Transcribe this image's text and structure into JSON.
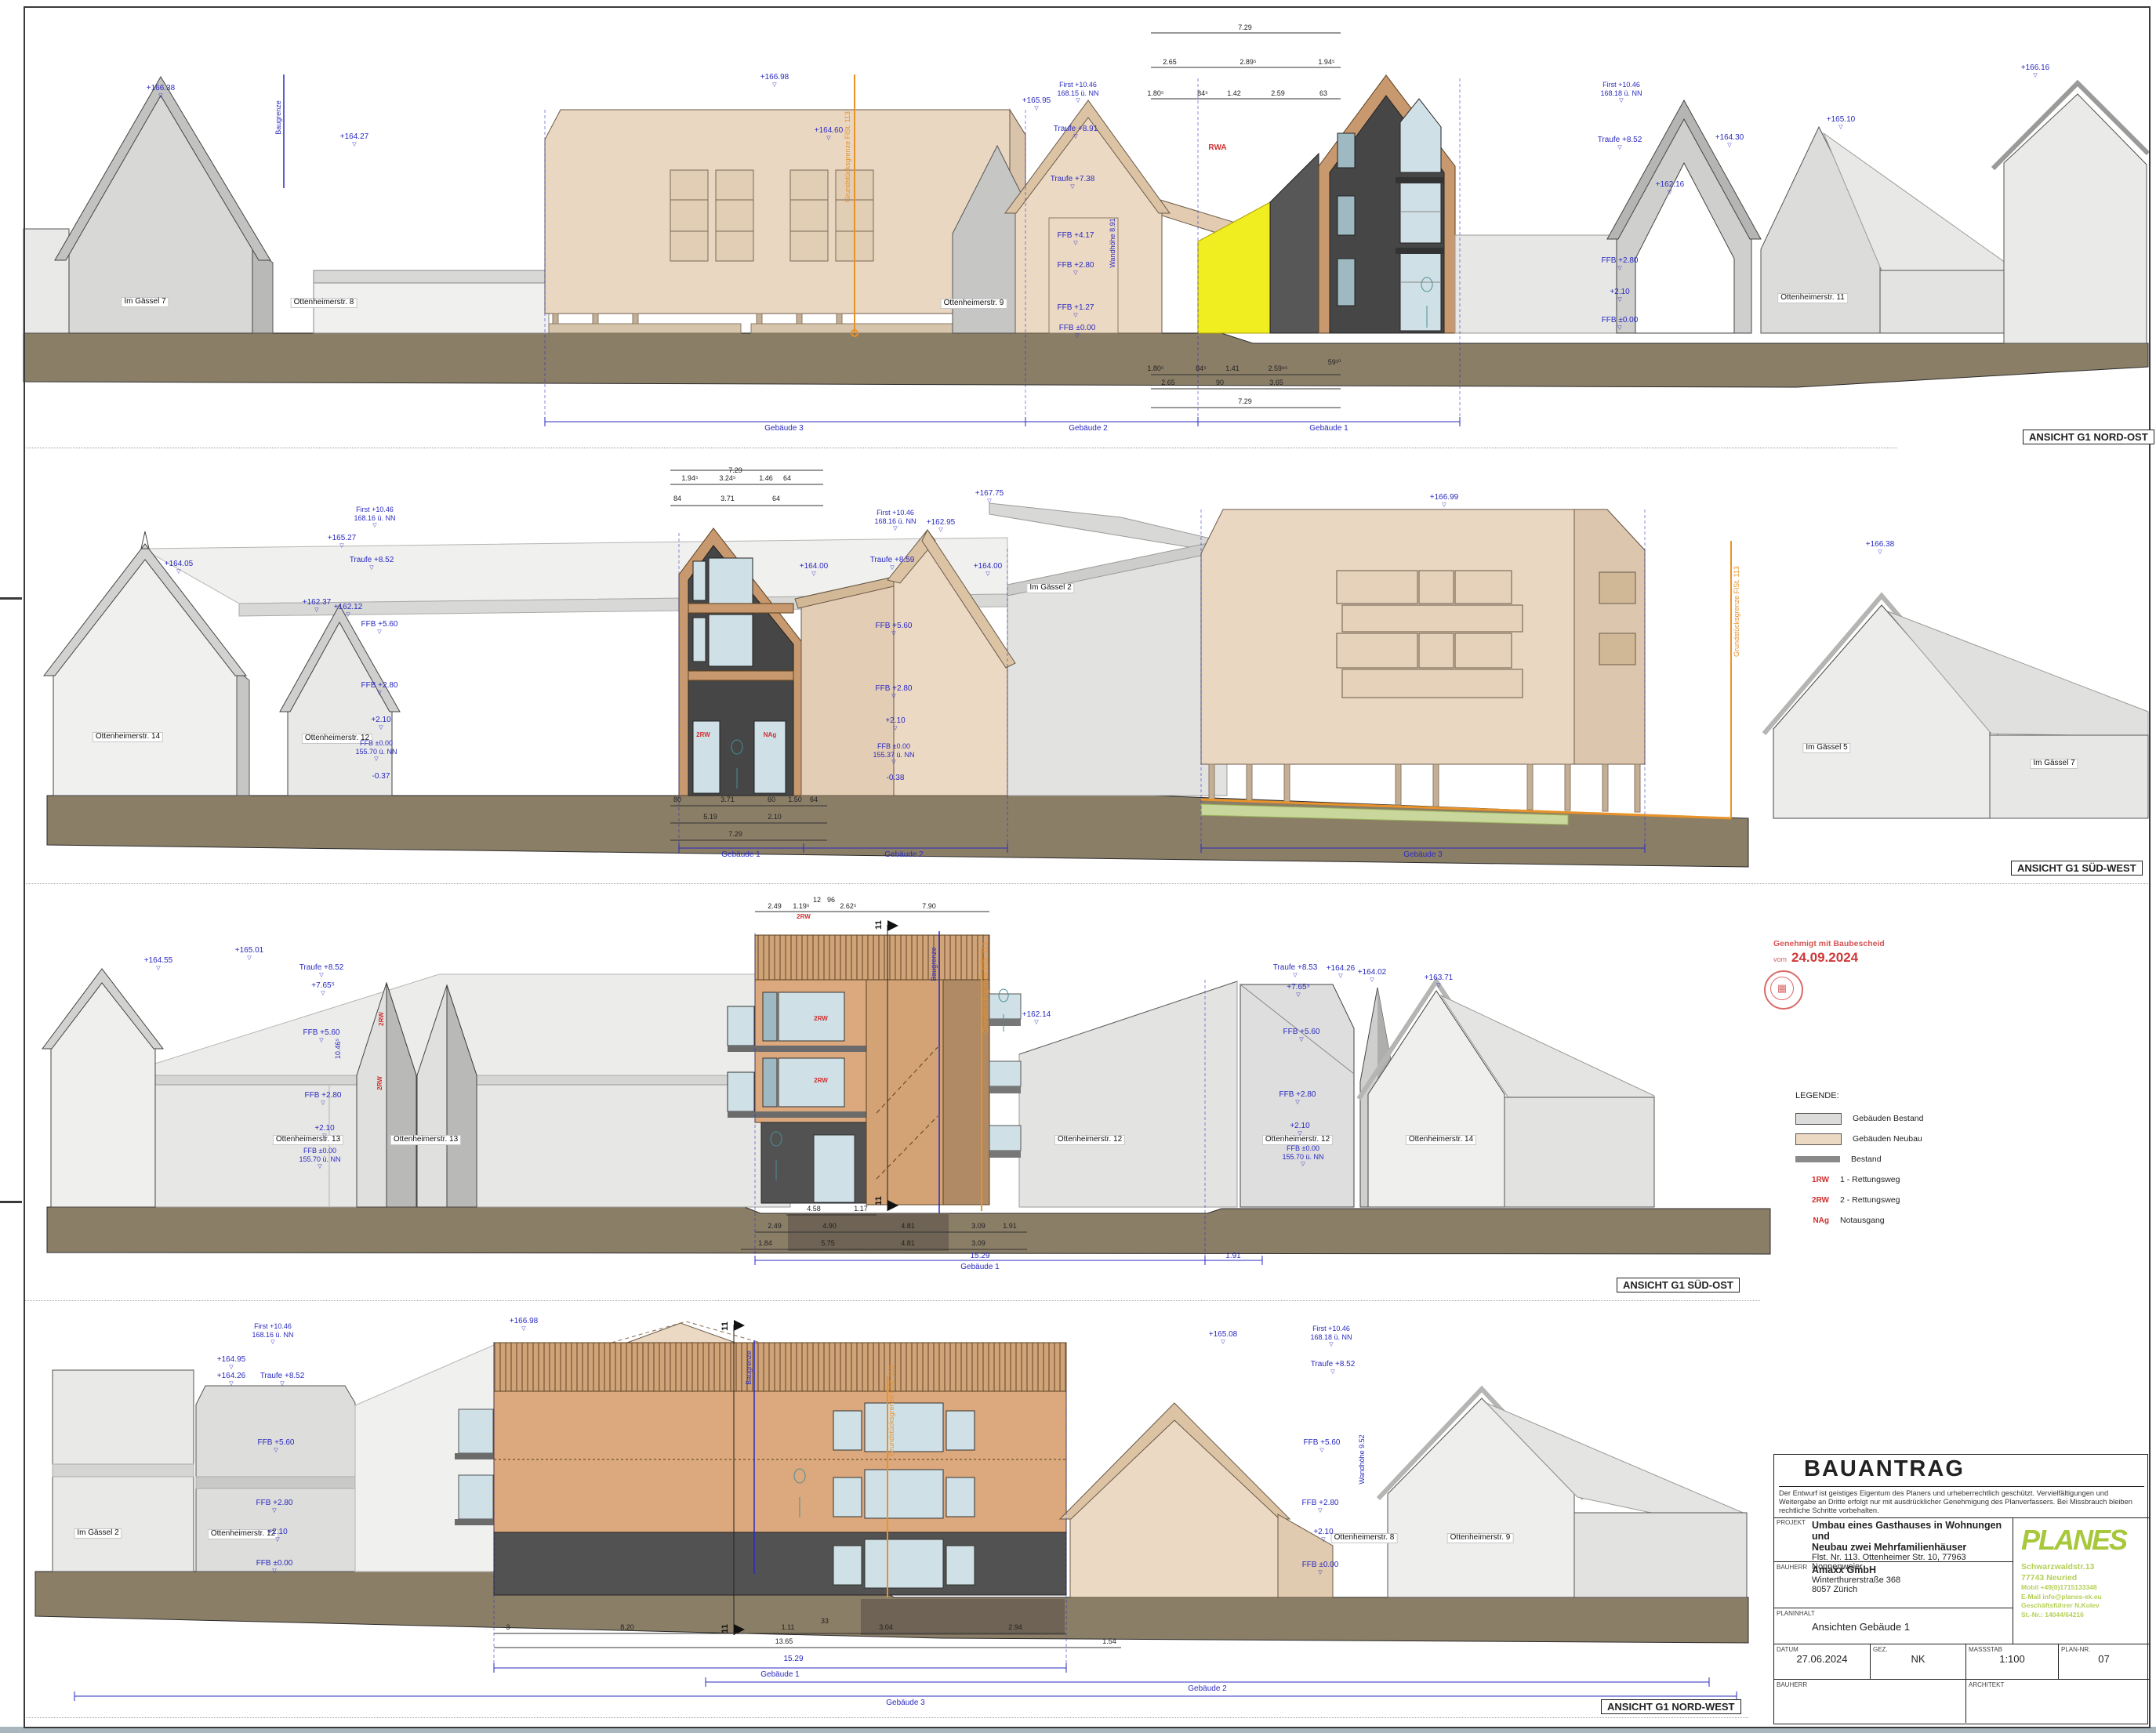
{
  "colors": {
    "neubau": "#ecd9c4",
    "bestand_wall": "#e7e7e5",
    "bestand_dark": "#8a8a88",
    "ground": "#8b7e67",
    "wood": "#c8996e",
    "annotation_blue": "#2a2ac0",
    "annotation_orange": "#e8922a",
    "alert_red": "#d03030",
    "logo_green": "#a8c83c",
    "highlight_yellow": "#f0ee20"
  },
  "elev1": {
    "title": "ANSICHT G1 NORD-OST",
    "streets": [
      "Im Gässel 7",
      "Ottenheimerstr. 8",
      "Ottenheimerstr. 9",
      "Ottenheimerstr. 11"
    ],
    "spans": [
      "Gebäude 3",
      "Gebäude 2",
      "Gebäude 1"
    ],
    "markers": [
      "+166.38",
      "+164.27",
      "+166.98",
      "+164.60",
      "First +10.46",
      "168.15 ü. NN",
      "+165.95",
      "Traufe +8.91",
      "Traufe +7.38",
      "FFB +4.17",
      "FFB +2.80",
      "FFB +1.27",
      "FFB ±0.00",
      "First +10.46",
      "168.18 ü. NN",
      "Traufe +8.52",
      "+165.10",
      "+164.30",
      "+162.16",
      "FFB +2.80",
      "+2.10",
      "FFB ±0.00",
      "+166.16"
    ],
    "notes": [
      "RWA"
    ],
    "rotated": [
      "Grundstücksgrenze FlSt. 113",
      "Baugrenze",
      "Wandhöhe 8.91"
    ],
    "dims": [
      "7.29",
      "2.65",
      "2.89⁵",
      "1.94⁵",
      "1.80⁵",
      "84⁵",
      "1.42",
      "2.59",
      "63",
      "1.80⁵",
      "84⁵",
      "1.41",
      "2.59⁹⁵",
      "59¹⁰",
      "2.65",
      "90",
      "3.65",
      "7.29"
    ]
  },
  "elev2": {
    "title": "ANSICHT G1 SÜD-WEST",
    "streets": [
      "Ottenheimerstr. 14",
      "Ottenheimerstr. 12",
      "Im Gässel 2",
      "Im Gässel 5",
      "Im Gässel 7"
    ],
    "spans": [
      "Gebäude 1",
      "Gebäude 2",
      "Gebäude 3"
    ],
    "markers": [
      "First +10.46",
      "168.16 ü. NN",
      "+165.27",
      "Traufe +8.52",
      "+164.05",
      "+162.37",
      "+162.12",
      "FFB +5.60",
      "FFB +2.80",
      "+2.10",
      "FFB ±0.00",
      "155.70 ü. NN",
      "-0.37",
      "First +10.46",
      "168.16 ü. NN",
      "+167.75",
      "+162.95",
      "Traufe +8.59",
      "+164.00",
      "+164.00",
      "FFB +5.60",
      "FFB +2.80",
      "+2.10",
      "FFB ±0.00",
      "155.37 ü. NN",
      "-0.38",
      "+166.99",
      "+166.38"
    ],
    "notes": [
      "2RW",
      "NAg"
    ],
    "rotated": [
      "Grundstücksgrenze FlSt. 113"
    ],
    "dims": [
      "7.29",
      "1.94⁵",
      "3.24⁵",
      "1.46",
      "64",
      "84",
      "3.71",
      "64",
      "80",
      "3.71",
      "60",
      "1.50",
      "64",
      "5.19",
      "2.10",
      "7.29"
    ]
  },
  "elev3": {
    "title": "ANSICHT G1 SÜD-OST",
    "streets": [
      "Ottenheimerstr. 13",
      "Ottenheimerstr. 13",
      "Ottenheimerstr. 12",
      "Ottenheimerstr. 12",
      "Ottenheimerstr. 14"
    ],
    "spans": [
      "Gebäude 1"
    ],
    "markers": [
      "+164.55",
      "+165.01",
      "Traufe +8.52",
      "+7.65⁵",
      "FFB +5.60",
      "FFB +2.80",
      "+2.10",
      "FFB ±0.00",
      "155.70 ü. NN",
      "+162.14",
      "Traufe +8.53",
      "+164.26",
      "+164.02",
      "+163.71",
      "+7.65⁵",
      "FFB +5.60",
      "FFB +2.80",
      "+2.10",
      "FFB ±0.00",
      "155.70 ü. NN"
    ],
    "notes": [
      "2RW",
      "2RW",
      "2RW",
      "2RW",
      "2RW"
    ],
    "rotated": [
      "Baugrenze",
      "Grundstücksgrenze FlSt. 113",
      "10.46⁵"
    ],
    "sections": [
      "11",
      "11"
    ],
    "dims": [
      "2.49",
      "1.19⁵",
      "12",
      "96",
      "2.62⁵",
      "7.90",
      "4.58",
      "1.17",
      "2.49",
      "4.90",
      "4.81",
      "3.09",
      "1.91",
      "1.84",
      "5.75",
      "4.81",
      "3.09",
      "15.29",
      "1.91"
    ]
  },
  "elev4": {
    "title": "ANSICHT G1 NORD-WEST",
    "streets": [
      "Im Gässel 2",
      "Ottenheimerstr. 12",
      "Ottenheimerstr. 8",
      "Ottenheimerstr. 9"
    ],
    "spans": [
      "Gebäude 1",
      "Gebäude 2",
      "Gebäude 3"
    ],
    "markers": [
      "First +10.46",
      "168.16 ü. NN",
      "+164.95",
      "+164.26",
      "Traufe +8.52",
      "FFB +5.60",
      "FFB +2.80",
      "+2.10",
      "FFB ±0.00",
      "+166.98",
      "First +10.46",
      "168.18 ü. NN",
      "+165.08",
      "Traufe +8.52",
      "FFB +5.60",
      "FFB +2.80",
      "+2.10",
      "FFB ±0.00"
    ],
    "rotated": [
      "Baugrenze",
      "Grundstücksgrenze FlSt. 113",
      "Wandhöhe 9.52"
    ],
    "sections": [
      "11",
      "11"
    ],
    "dims": [
      "3",
      "8.20",
      "1.11",
      "33",
      "3.04",
      "2.94",
      "13.65",
      "1.54",
      "15.29"
    ]
  },
  "legend": {
    "title": "LEGENDE:",
    "items": [
      {
        "key": "",
        "label": "Gebäuden Bestand"
      },
      {
        "key": "",
        "label": "Gebäuden Neubau"
      },
      {
        "key": "",
        "label": "Bestand"
      },
      {
        "key": "1RW",
        "label": "1 - Rettungsweg"
      },
      {
        "key": "2RW",
        "label": "2 - Rettungsweg"
      },
      {
        "key": "NAg",
        "label": "Notausgang"
      }
    ]
  },
  "stamp": {
    "line1": "Genehmigt mit Baubescheid",
    "prefix": "vom",
    "date": "24.09.2024"
  },
  "title_block": {
    "heading": "BAUANTRAG",
    "copyright": "Der Entwurf ist geistiges Eigentum des Planers und urheberrechtlich geschützt. Vervielfältigungen und Weitergabe an Dritte erfolgt nur mit ausdrücklicher Genehmigung des Planverfassers. Bei Missbrauch bleiben rechtliche Schritte vorbehalten.",
    "projekt_label": "PROJEKT",
    "projekt_line1": "Umbau eines Gasthauses in Wohnungen und",
    "projekt_line2": "Neubau zwei Mehrfamilienhäuser",
    "projekt_line3": "Flst. Nr. 113. Ottenheimer Str. 10, 77963 Nonnenweier",
    "bauherr_label": "BAUHERR",
    "bauherr_line1": "Amaxx GmbH",
    "bauherr_line2": "Winterthurerstraße 368",
    "bauherr_line3": "8057 Zürich",
    "planinhalt_label": "PLANINHALT",
    "planinhalt_value": "Ansichten Gebäude 1",
    "datum_label": "DATUM",
    "datum": "27.06.2024",
    "gez_label": "GEZ.",
    "gez": "NK",
    "massstab_label": "MASSSTAB",
    "massstab": "1:100",
    "plannr_label": "PLAN-NR.",
    "plannr": "07",
    "bauherr2_label": "BAUHERR",
    "architekt_label": "ARCHITEKT",
    "logo_name": "PLANES",
    "logo_addr1": "Schwarzwaldstr.13",
    "logo_addr2": "77743 Neuried",
    "logo_addr3": "Mobil +49(0)1715133348",
    "logo_addr4": "E-Mail info@planes-ek.eu",
    "logo_addr5": "Geschäftsführer N.Kolev",
    "logo_addr6": "St.-Nr.: 14044/64216"
  }
}
